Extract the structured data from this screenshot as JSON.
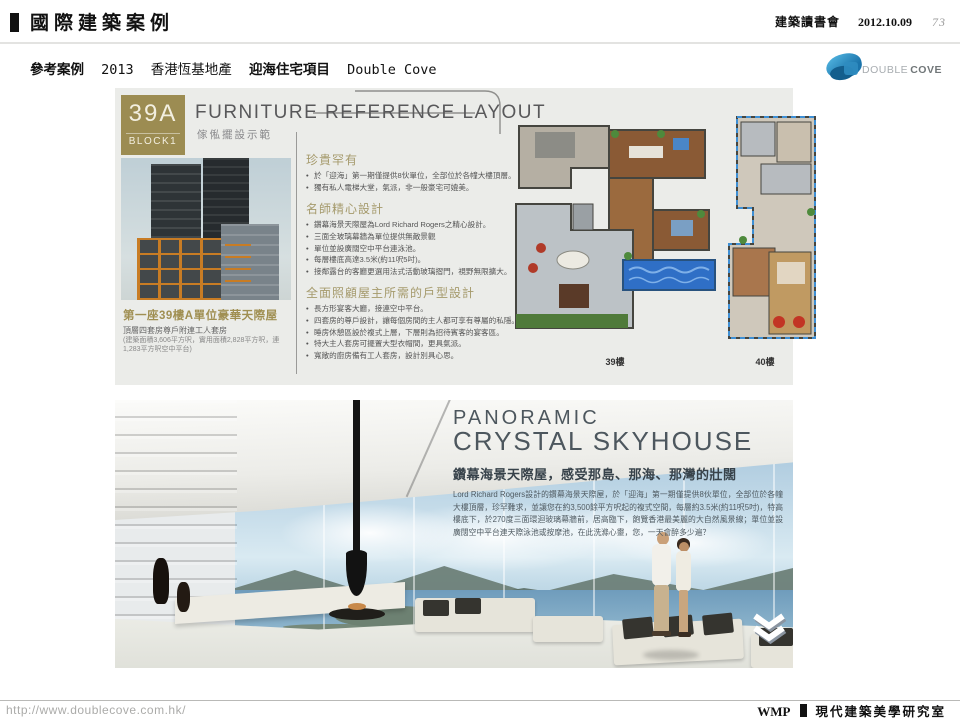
{
  "meta": {
    "header_title": "國際建築案例",
    "header_group": "建築讀書會",
    "header_date": "2012.10.09",
    "page_number": "73",
    "subtitle_prefix": "參考案例",
    "subtitle_year": "2013",
    "subtitle_developer": "香港恆基地產",
    "subtitle_project": "迎海住宅項目",
    "subtitle_project_en": "Double Cove",
    "logo_word1": "DOUBLE",
    "logo_word2": "COVE",
    "footer_url": "http://www.doublecove.com.hk/",
    "footer_brand": "WMP",
    "footer_org": "現代建築美學研究室"
  },
  "panel1": {
    "badge_line1": "39A",
    "badge_line2": "BLOCK1",
    "title_en": "FURNITURE REFERENCE LAYOUT",
    "title_zh": "傢俬擺設示範",
    "unit_heading": "第一座39樓A單位豪華天際屋",
    "unit_sub1": "頂層四套房尊戶附連工人套房",
    "unit_sub2": "(建築面積3,606平方呎，實用面積2,828平方呎，連1,283平方呎空中平台)",
    "sections": [
      {
        "heading": "珍貴罕有",
        "bullets": [
          "於「迎海」第一期僅提供8伙單位，全部位於各幢大樓頂層。",
          "獨有私人電梯大堂，氣派，非一般豪宅可媲美。"
        ]
      },
      {
        "heading": "名師精心設計",
        "bullets": [
          "鑽幕海景天際屋為Lord Richard Rogers之精心設計。",
          "三面全玻璃幕牆為單位提供無敵景觀",
          "單位並設廣闊空中平台連泳池。",
          "每層樓底高達3.5米(約11呎5吋)。",
          "接鄰露台的客廳更選用法式活動玻璃摺門，視野無限擴大。"
        ]
      },
      {
        "heading": "全面照顧屋主所需的戶型設計",
        "bullets": [
          "長方形宴客大廳，接連空中平台。",
          "四套房的尊戶設計，讓每個房間的主人都可享有尊屬的私隱。",
          "睡房休憩區設於複式上層，下層則為招待賓客的宴客區。",
          "特大主人套房可擺置大型衣帽間，更具氣派。",
          "寬敞的廚房備有工人套房，設計別具心思。"
        ]
      }
    ],
    "floorplan_labels": [
      "39樓",
      "40樓"
    ]
  },
  "panel2": {
    "title_line1": "PANORAMIC",
    "title_line2": "CRYSTAL SKYHOUSE",
    "heading_zh": "鑽幕海景天際屋，感受那島、那海、那灣的壯闊",
    "body": "Lord Richard Rogers設計的鑽幕海景天際屋，於「迎海」第一期僅提供8伙單位，全部位於各幢大樓頂層，珍罕難求，並讓您在約3,500餘平方呎起的複式空間，每層約3.5米(約11呎5吋)，特高樓底下，於270度三面環迴玻璃幕牆前，居高臨下，飽覽香港最美麗的大自然風景線；單位並設廣闊空中平台連天際泳池或按摩池，在此洗滌心靈，您，一天會醉多少遍？"
  }
}
